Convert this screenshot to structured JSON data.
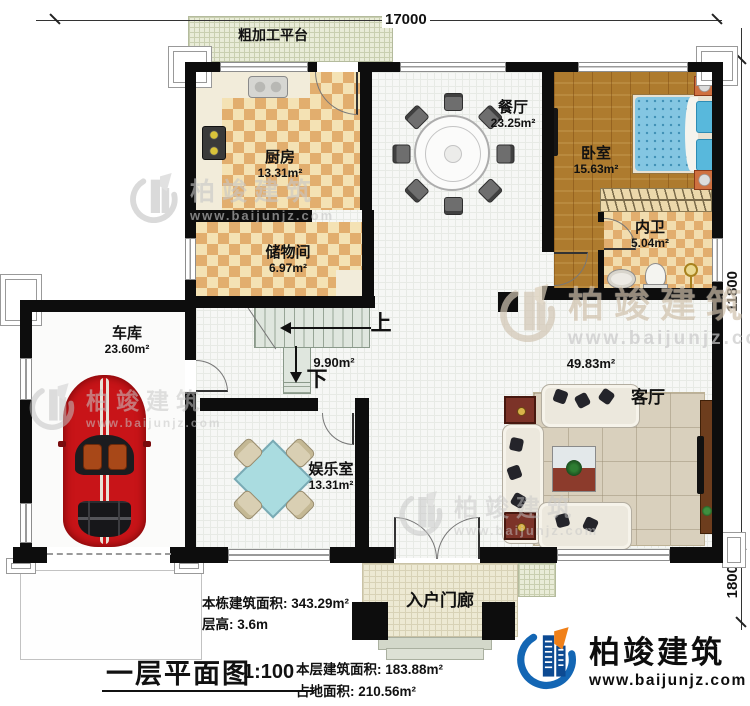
{
  "plan": {
    "title": "一层平面图",
    "scale": "1:100",
    "dims": {
      "top": "17000",
      "right": "11800",
      "porch_depth": "1800"
    },
    "rooms": {
      "platform": {
        "name": "粗加工平台"
      },
      "kitchen": {
        "name": "厨房",
        "area": "13.31m²"
      },
      "storage": {
        "name": "储物间",
        "area": "6.97m²"
      },
      "dining": {
        "name": "餐厅",
        "area": "23.25m²"
      },
      "bedroom": {
        "name": "卧室",
        "area": "15.63m²"
      },
      "bathroom": {
        "name": "内卫",
        "area": "5.04m²"
      },
      "garage": {
        "name": "车库",
        "area": "23.60m²"
      },
      "entertainment": {
        "name": "娱乐室",
        "area": "13.31m²"
      },
      "living": {
        "name": "客厅",
        "area": "49.83m²"
      },
      "stairs": {
        "area": "9.90m²",
        "up": "上",
        "down": "下"
      },
      "porch": {
        "name": "入户门廊"
      }
    },
    "stats": {
      "building_area_label": "本栋建筑面积:",
      "building_area": "343.29m²",
      "floor_height_label": "层高:",
      "floor_height": "3.6m",
      "floor_area_label": "本层建筑面积:",
      "floor_area": "183.88m²",
      "footprint_label": "占地面积:",
      "footprint": "210.56m²"
    },
    "branding": {
      "company": "柏竣建筑",
      "website": "www.baijunjz.com"
    },
    "colors": {
      "wall": "#0d0d0d",
      "checker": "#e2ae6e",
      "wood": "#ae7b2e",
      "brand_blue": "#1366b4",
      "brand_orange": "#f08019",
      "bed_blue": "#7ec3e0",
      "car_red": "#c81418",
      "table_cyan": "#aadce0"
    }
  }
}
